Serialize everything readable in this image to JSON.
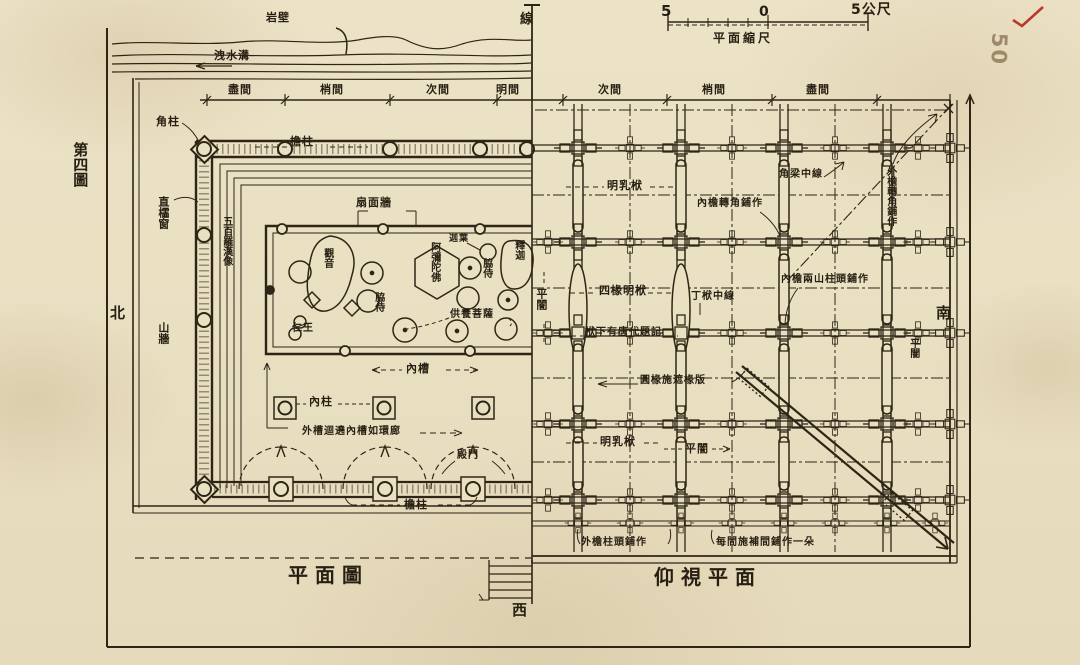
{
  "page": {
    "figure_label": "第四圖",
    "page_number": "50",
    "checkmark_color": "#b8392a",
    "ink_color": "#2e2516",
    "paper_color": "#eae0c2"
  },
  "titles": {
    "floor_plan": "平面圖",
    "ceiling_plan": "仰視平面"
  },
  "compass": {
    "north": "北",
    "south": "南",
    "west": "西",
    "center_line": "線"
  },
  "scale_bar": {
    "left_value": "5",
    "zero": "0",
    "right_value": "5公尺",
    "caption": "平面縮尺"
  },
  "annotations": [
    {
      "name": "label-rock-cliff",
      "text": "岩壁",
      "x": 266,
      "y": 12
    },
    {
      "name": "label-drainage-ditch",
      "text": "洩水溝",
      "x": 214,
      "y": 50
    },
    {
      "name": "bay-left-jinjian",
      "text": "盡間",
      "x": 228,
      "y": 84
    },
    {
      "name": "bay-left-shaojian",
      "text": "梢間",
      "x": 320,
      "y": 84
    },
    {
      "name": "bay-left-cijian",
      "text": "次間",
      "x": 426,
      "y": 84
    },
    {
      "name": "bay-mingjian",
      "text": "明間",
      "x": 496,
      "y": 84
    },
    {
      "name": "bay-right-cijian",
      "text": "次間",
      "x": 598,
      "y": 84
    },
    {
      "name": "bay-right-shaojian",
      "text": "梢間",
      "x": 702,
      "y": 84
    },
    {
      "name": "bay-right-jinjian",
      "text": "盡間",
      "x": 806,
      "y": 84
    },
    {
      "name": "label-corner-column",
      "text": "角柱",
      "x": 156,
      "y": 116
    },
    {
      "name": "label-lattice-window",
      "text": "直櫺窗",
      "x": 157,
      "y": 196,
      "vert": true
    },
    {
      "name": "label-500-luohan",
      "text": "五百羅漢像",
      "x": 220,
      "y": 216,
      "vert": true,
      "size": 10
    },
    {
      "name": "label-gable-wall",
      "text": "山牆",
      "x": 157,
      "y": 322,
      "vert": true
    },
    {
      "name": "label-eave-column-top",
      "text": "檐柱",
      "x": 290,
      "y": 136
    },
    {
      "name": "label-fan-wall",
      "text": "扇面牆",
      "x": 356,
      "y": 197
    },
    {
      "name": "label-guanyin",
      "text": "觀音",
      "x": 321,
      "y": 248,
      "vert": true,
      "size": 10
    },
    {
      "name": "label-amitabha",
      "text": "阿彌陀佛",
      "x": 428,
      "y": 242,
      "vert": true,
      "size": 10
    },
    {
      "name": "label-jiaye",
      "text": "迦葉",
      "x": 449,
      "y": 235,
      "size": 9
    },
    {
      "name": "label-shijia",
      "text": "釋迦",
      "x": 512,
      "y": 240,
      "vert": true,
      "size": 10
    },
    {
      "name": "label-attendant-right",
      "text": "脇侍",
      "x": 480,
      "y": 258,
      "vert": true,
      "size": 10
    },
    {
      "name": "label-attendant-mid",
      "text": "脇侍",
      "x": 372,
      "y": 292,
      "vert": true,
      "size": 10
    },
    {
      "name": "label-offering-bodhisattva",
      "text": "供養菩薩",
      "x": 450,
      "y": 310,
      "size": 10
    },
    {
      "name": "label-renwang",
      "text": "仁王",
      "x": 292,
      "y": 324,
      "size": 10
    },
    {
      "name": "label-inner-cao",
      "text": "內槽",
      "x": 406,
      "y": 363
    },
    {
      "name": "label-inner-column",
      "text": "內柱",
      "x": 309,
      "y": 396
    },
    {
      "name": "label-outer-cao-corridor",
      "text": "外槽迴遶內槽如環廊",
      "x": 302,
      "y": 427,
      "size": 10
    },
    {
      "name": "label-hall-door",
      "text": "殿門",
      "x": 457,
      "y": 451,
      "size": 10
    },
    {
      "name": "label-eave-column-bottom",
      "text": "檐柱",
      "x": 404,
      "y": 499
    },
    {
      "name": "label-mingrufu-top",
      "text": "明乳栿",
      "x": 607,
      "y": 180
    },
    {
      "name": "label-inner-eave-corner-puzuo",
      "text": "內檐轉角鋪作",
      "x": 697,
      "y": 199,
      "size": 10
    },
    {
      "name": "label-corner-beam-centerline",
      "text": "角梁中線",
      "x": 779,
      "y": 170,
      "size": 10
    },
    {
      "name": "label-outer-eave-corner-puzuo",
      "text": "外檐轉角鋪作",
      "x": 884,
      "y": 166,
      "vert": true,
      "size": 10
    },
    {
      "name": "label-pingan-left",
      "text": "平闇",
      "x": 535,
      "y": 288,
      "vert": true
    },
    {
      "name": "label-four-rafter-beam",
      "text": "四椽明栿",
      "x": 599,
      "y": 285
    },
    {
      "name": "label-dingfu-centerline",
      "text": "丁栿中線",
      "x": 691,
      "y": 292,
      "size": 10
    },
    {
      "name": "label-inner-eave-gable-puzuo",
      "text": "內檐兩山柱頭鋪作",
      "x": 781,
      "y": 275,
      "size": 10
    },
    {
      "name": "label-tang-inscription",
      "text": "栿下有唐代題記",
      "x": 585,
      "y": 328,
      "size": 10
    },
    {
      "name": "label-rafter-board",
      "text": "圓椽施遮椽版",
      "x": 640,
      "y": 376,
      "size": 10
    },
    {
      "name": "label-mingrufu-bottom",
      "text": "明乳栿",
      "x": 600,
      "y": 436
    },
    {
      "name": "label-pingan-bottom",
      "text": "平闇",
      "x": 685,
      "y": 443
    },
    {
      "name": "label-pingan-right",
      "text": "平闇",
      "x": 907,
      "y": 338,
      "vert": true,
      "size": 10
    },
    {
      "name": "label-outer-eave-column-puzuo",
      "text": "外檐柱頭鋪作",
      "x": 581,
      "y": 538,
      "size": 10
    },
    {
      "name": "label-intermediate-puzuo",
      "text": "每間施補間鋪作一朵",
      "x": 716,
      "y": 538,
      "size": 10
    }
  ]
}
